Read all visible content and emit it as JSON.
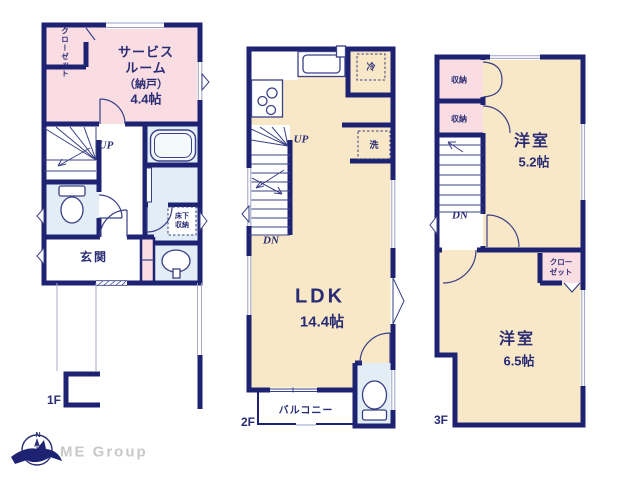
{
  "colors": {
    "wall_navy": "#1e2272",
    "text_navy": "#2a2d75",
    "room_pink": "#fadde2",
    "room_cream": "#f8e8c7",
    "room_blue": "#e2edf5",
    "logo_gray": "#c9c9c9"
  },
  "floor1": {
    "label": "1F",
    "closet_vertical": "クローゼット",
    "service_room_line1": "サービス",
    "service_room_line2": "ルーム",
    "service_room_line3": "（納戸）",
    "service_room_size": "4.4帖",
    "stairs_up": "UP",
    "underfloor_line1": "床下",
    "underfloor_line2": "収納",
    "entrance": "玄関"
  },
  "floor2": {
    "label": "2F",
    "fridge": "冷",
    "washer": "洗",
    "stairs_up": "UP",
    "stairs_down": "DN",
    "ldk_name": "LDK",
    "ldk_size": "14.4帖",
    "balcony": "バルコニー"
  },
  "floor3": {
    "label": "3F",
    "storage_top": "収納",
    "storage_bottom": "収納",
    "room_a_name": "洋室",
    "room_a_size": "5.2帖",
    "stairs_down": "DN",
    "closet_line1": "クロー",
    "closet_line2": "ゼット",
    "room_b_name": "洋室",
    "room_b_size": "6.5帖"
  },
  "logo": {
    "compass_n": "N",
    "company": "ME Group"
  }
}
